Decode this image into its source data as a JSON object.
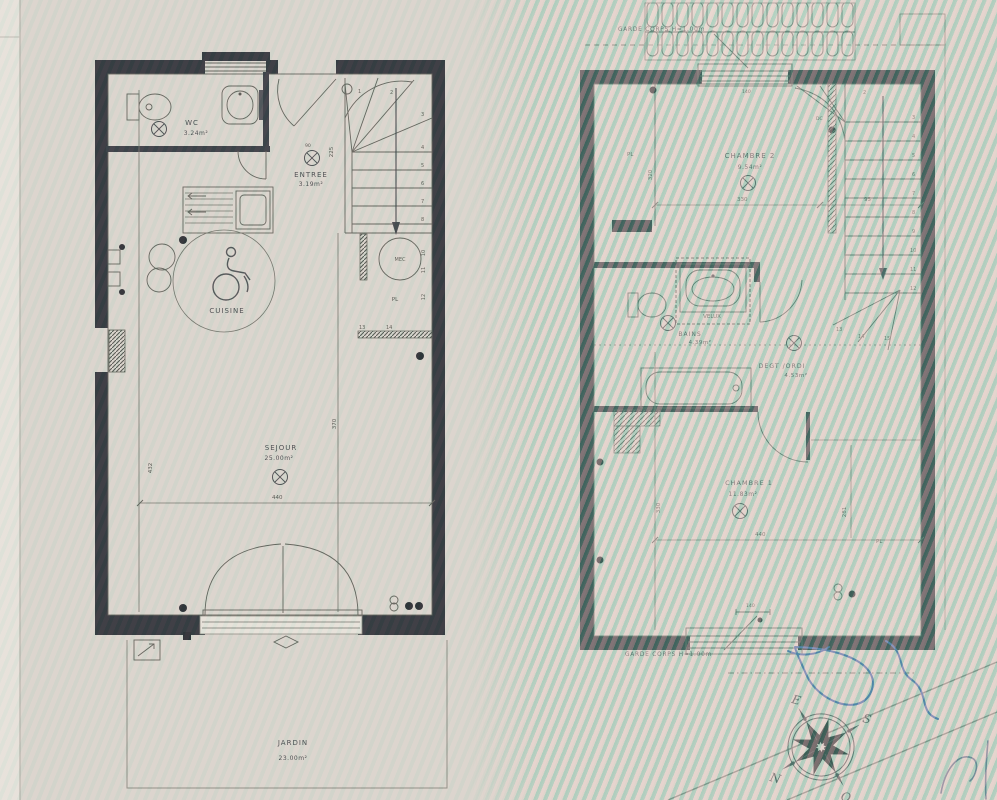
{
  "ground_floor": {
    "rooms": {
      "wc_name": "WC",
      "wc_area": "3.24m²",
      "entree_name": "ENTREE",
      "entree_area": "3.19m²",
      "cuisine_name": "CUISINE",
      "sejour_name": "SEJOUR",
      "sejour_area": "25.00m²",
      "jardin_name": "JARDIN",
      "jardin_area": "23.00m²"
    },
    "labels": {
      "mec": "MEC",
      "pl": "PL"
    },
    "dims": {
      "width": "440",
      "depth": "432",
      "sejour_h": "370",
      "entry": "225",
      "door": "90"
    },
    "stairs": [
      "1",
      "2",
      "3",
      "4",
      "5",
      "6",
      "7",
      "8"
    ],
    "side_numbers": [
      "10",
      "11",
      "12",
      "13",
      "14"
    ]
  },
  "upper_floor": {
    "rooms": {
      "chambre2_name": "CHAMBRE 2",
      "chambre2_area": "9.54m²",
      "bains_name": "BAINS",
      "bains_area": "4.39m²",
      "velux": "VELUX",
      "degt_name": "DEGT /ORDI",
      "degt_area": "4.53m²",
      "chambre1_name": "CHAMBRE 1",
      "chambre1_area": "11.83m²"
    },
    "labels": {
      "pl_top": "PL",
      "pl_bottom": "PL",
      "dc": "DC",
      "garde_corps_top": "GARDE CORPS H=1.00m",
      "garde_corps_bottom": "GARDE CORPS H=1.00m"
    },
    "dims": {
      "w330": "330",
      "w95": "95",
      "w440": "440",
      "d281": "281",
      "h320": "320",
      "h330": "330",
      "win140": "140"
    },
    "stairs": [
      "2",
      "3",
      "4",
      "5",
      "6",
      "7",
      "8",
      "9",
      "10",
      "11",
      "12",
      "13",
      "14",
      "15"
    ]
  },
  "compass": {
    "n": "N",
    "s": "S",
    "e": "E",
    "o": "O"
  },
  "colors": {
    "wall": "#2b2e36",
    "pen_blue": "#3a62a8",
    "paper": "#d9d5cd"
  }
}
